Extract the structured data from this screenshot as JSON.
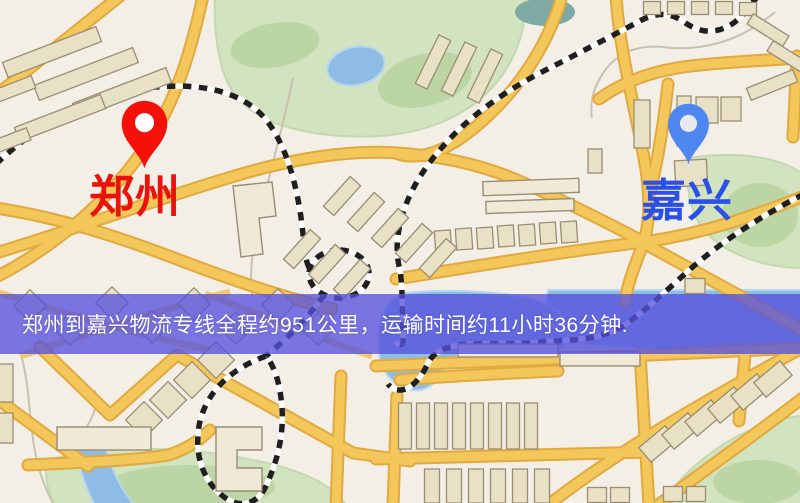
{
  "map_image": {
    "origin": {
      "name": "郑州",
      "pin_color": "#f5100a",
      "pin_dot_color": "#ffffff",
      "label_color": "#ea130b"
    },
    "destination": {
      "name": "嘉兴",
      "pin_color": "#4f87f0",
      "pin_dot_color": "#e9e8ec",
      "label_color": "#2b50e8"
    },
    "banner": {
      "text": "郑州到嘉兴物流专线全程约951公里，运输时间约11小时36分钟.",
      "background_color": "#5651dc",
      "text_color": "#ffffff",
      "distance_km": "951",
      "duration_hours": "11",
      "duration_minutes": "36"
    },
    "palette": {
      "background": "#f4efe6",
      "road_fill": "#f3c75a",
      "road_casing": "#e1a93f",
      "building_fill": "#e9e1c6",
      "building_stroke": "#9a8d72",
      "park_green": "#d2e3bf",
      "park_dark_green": "#bcd5a5",
      "water_blue": "#8fbce4",
      "railway_black": "#1f1f1f"
    }
  }
}
